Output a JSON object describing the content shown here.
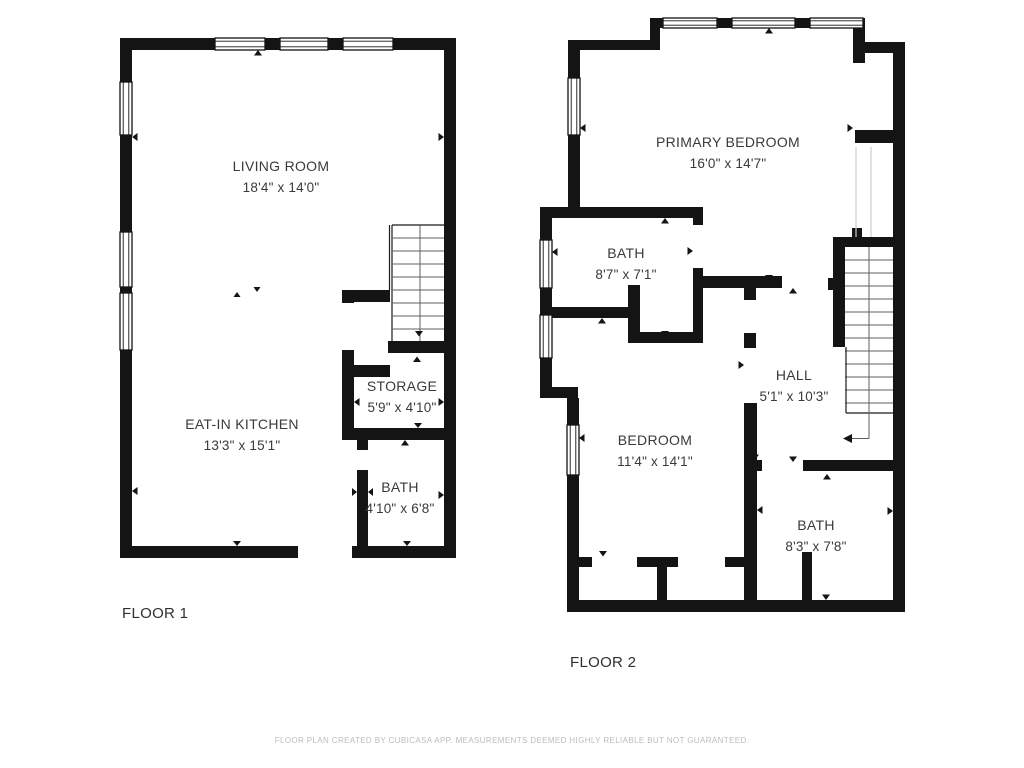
{
  "floor1": {
    "label": "FLOOR 1",
    "rooms": {
      "living": {
        "name": "LIVING ROOM",
        "dims": "18'4\" x 14'0\""
      },
      "kitchen": {
        "name": "EAT-IN KITCHEN",
        "dims": "13'3\" x 15'1\""
      },
      "storage": {
        "name": "STORAGE",
        "dims": "5'9\" x 4'10\""
      },
      "bath": {
        "name": "BATH",
        "dims": "4'10\" x 6'8\""
      }
    }
  },
  "floor2": {
    "label": "FLOOR 2",
    "rooms": {
      "primary": {
        "name": "PRIMARY BEDROOM",
        "dims": "16'0\" x 14'7\""
      },
      "bath_upper": {
        "name": "BATH",
        "dims": "8'7\" x 7'1\""
      },
      "hall": {
        "name": "HALL",
        "dims": "5'1\" x 10'3\""
      },
      "bedroom": {
        "name": "BEDROOM",
        "dims": "11'4\" x 14'1\""
      },
      "bath_lower": {
        "name": "BATH",
        "dims": "8'3\" x 7'8\""
      }
    }
  },
  "footer": {
    "disclaimer": "FLOOR PLAN CREATED BY CUBICASA APP. MEASUREMENTS DEEMED HIGHLY RELIABLE BUT NOT GUARANTEED."
  },
  "colors": {
    "wall": "#141414",
    "label_text": "#3a3a3a",
    "muted_text": "#bcbcbc"
  }
}
